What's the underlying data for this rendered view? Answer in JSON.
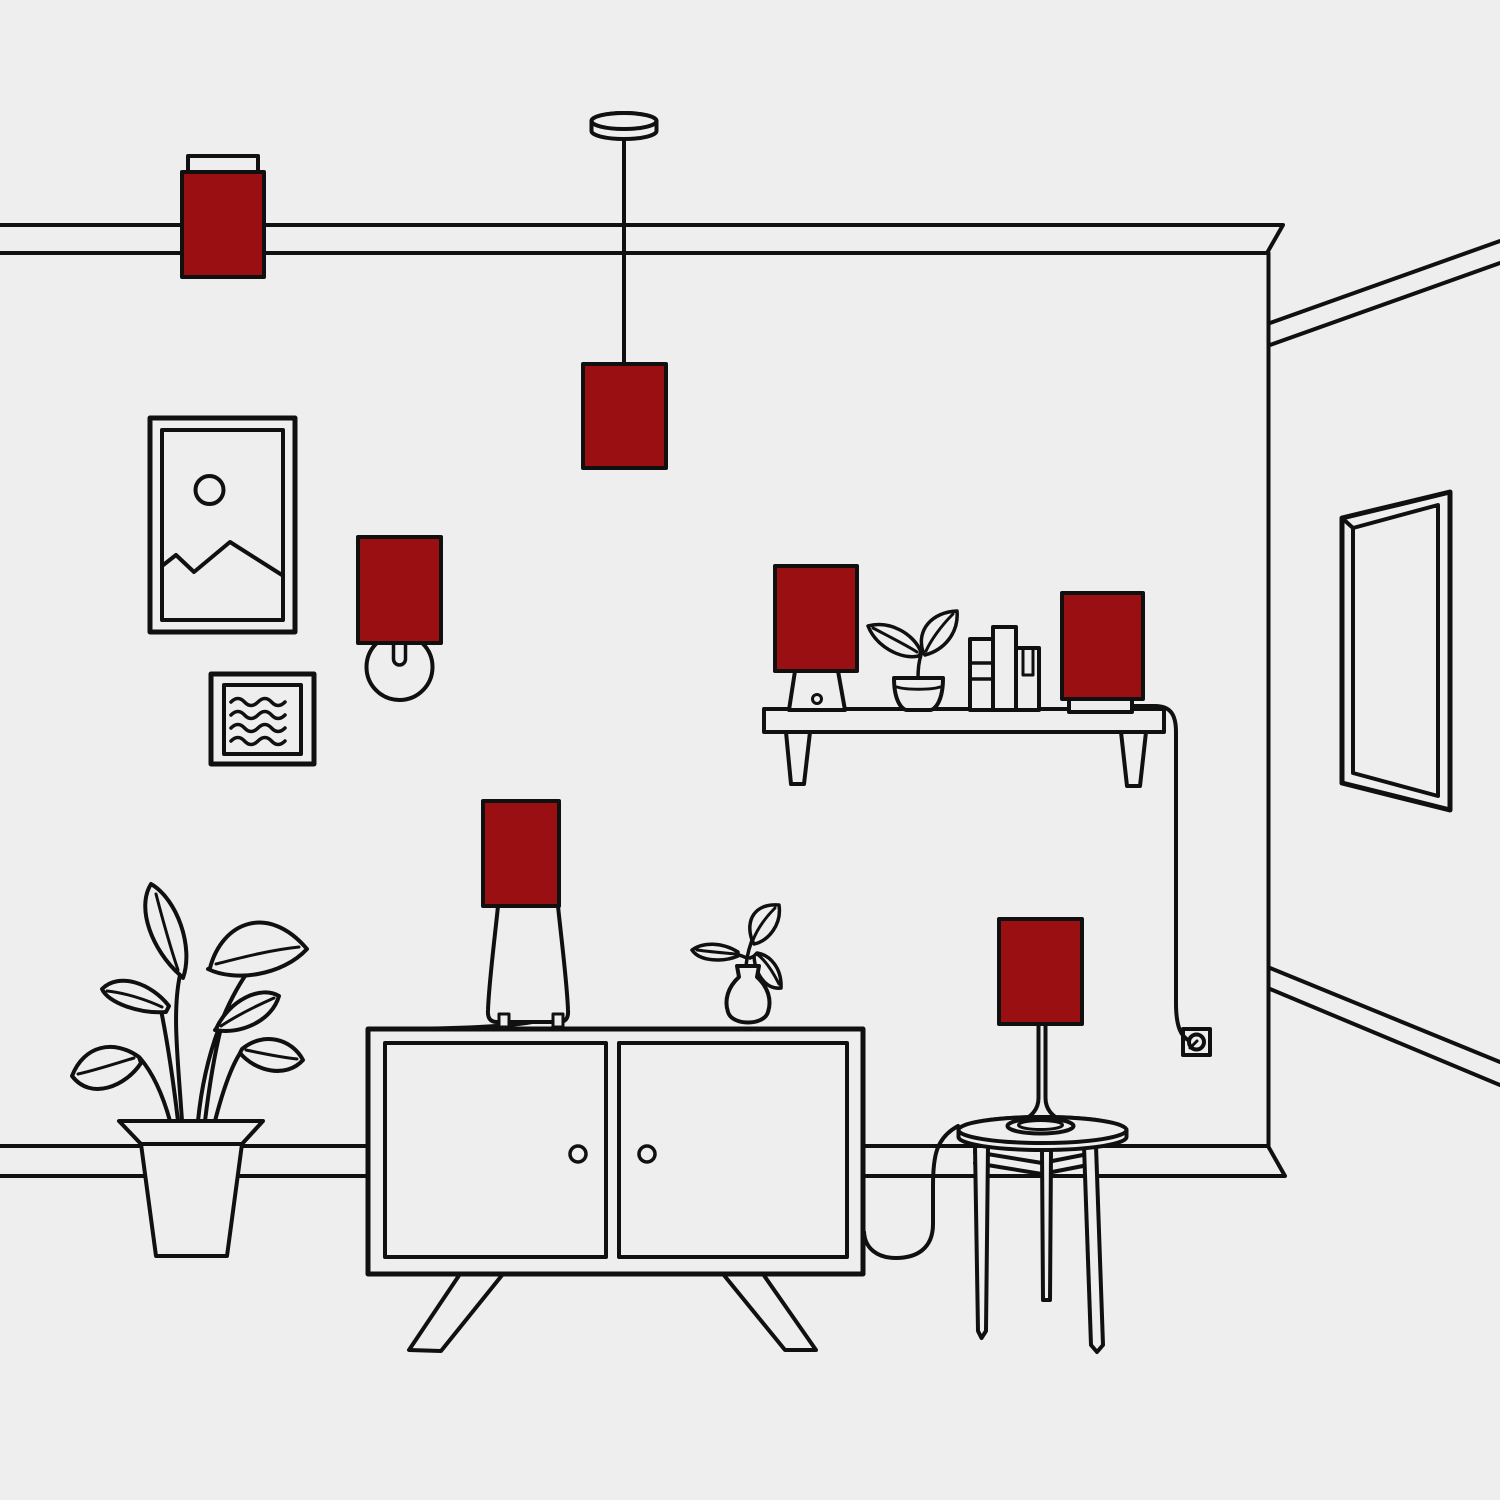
{
  "title": "Line-art living room illustration with highlighted lamp shades",
  "colors": {
    "background": "#EDEEED",
    "line": "#101010",
    "lamp_red": "#9A0F11"
  },
  "scene": {
    "style": "black outline illustration, flat light-gray background",
    "highlight_color_name": "dark red",
    "objects": [
      {
        "name": "flush-mount-ceiling-lamp",
        "highlighted": true
      },
      {
        "name": "pendant-lamp",
        "highlighted": true
      },
      {
        "name": "wall-sconce-lamp",
        "highlighted": true
      },
      {
        "name": "picture-frame-mountain",
        "highlighted": false
      },
      {
        "name": "picture-frame-abstract",
        "highlighted": false
      },
      {
        "name": "wall-shelf",
        "highlighted": false
      },
      {
        "name": "shelf-lamp-left",
        "highlighted": true
      },
      {
        "name": "shelf-plant",
        "highlighted": false
      },
      {
        "name": "books",
        "highlighted": false
      },
      {
        "name": "shelf-lamp-right",
        "highlighted": true
      },
      {
        "name": "power-outlet",
        "highlighted": false
      },
      {
        "name": "wall-mirror",
        "highlighted": false
      },
      {
        "name": "floor-plant",
        "highlighted": false
      },
      {
        "name": "sideboard-cabinet",
        "highlighted": false
      },
      {
        "name": "table-lamp-on-sideboard",
        "highlighted": true
      },
      {
        "name": "flower-vase",
        "highlighted": false
      },
      {
        "name": "side-table",
        "highlighted": false
      },
      {
        "name": "slim-table-lamp",
        "highlighted": true
      }
    ]
  }
}
